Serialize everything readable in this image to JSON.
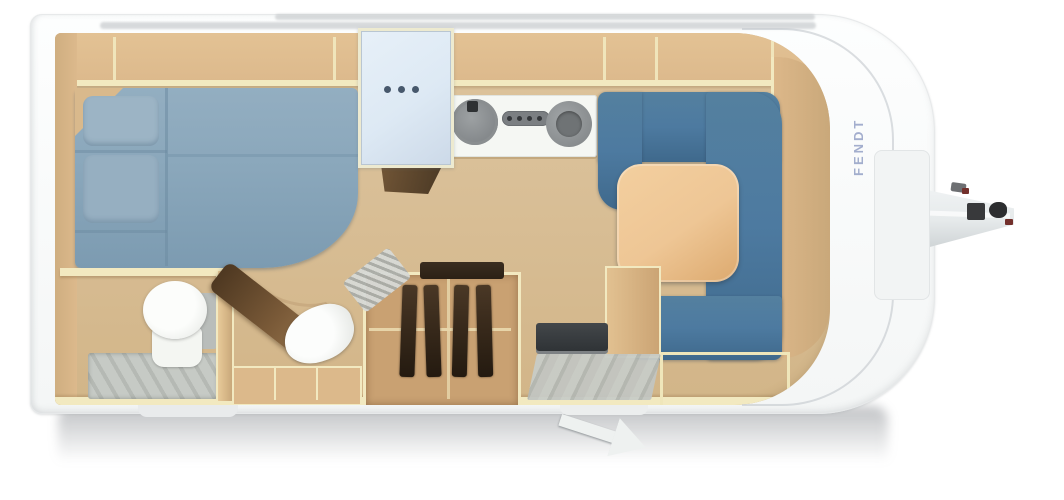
{
  "brand": {
    "label": "FENDT"
  },
  "colors": {
    "shell": "#fcfdfd",
    "shellEdge": "#e7e9ea",
    "floor": "#d9bf97",
    "wall": "#dcb98c",
    "wallEdge": "#f2e9c0",
    "wallDark": "#c9a87a",
    "bed": "#8aa7bb",
    "bedSeam": "#6d8ca2",
    "pillow": "#9cb4c5",
    "seat": "#4d7aa0",
    "seatDeep": "#3f698c",
    "table": "#eec695",
    "tableDeep": "#dca96e",
    "fridge": "#dde9f4",
    "fridgeDot": "#47586c",
    "counter": "#f5f7f3",
    "steel": "#8e9295",
    "steelDark": "#2e3133",
    "toilet": "#f4f6f2",
    "tank": "#b9bdba",
    "shower": "#c6cac5",
    "showerDark": "#b5b9b4",
    "clothes": "#3a2b1c",
    "doorWood": "#7a5a38",
    "doorWoodDark": "#4e3821",
    "shelfDark": "#2c2115",
    "heater": "#2f3336",
    "stepGray": "#c8ccc7",
    "stepGrayDark": "#b3b7b2",
    "hitch": "#e6eaeb",
    "hitchDark": "#38393b",
    "accentRed": "#73302c",
    "brandText": "#94a1c6",
    "shadow": "rgba(105,110,116,0.42)"
  }
}
